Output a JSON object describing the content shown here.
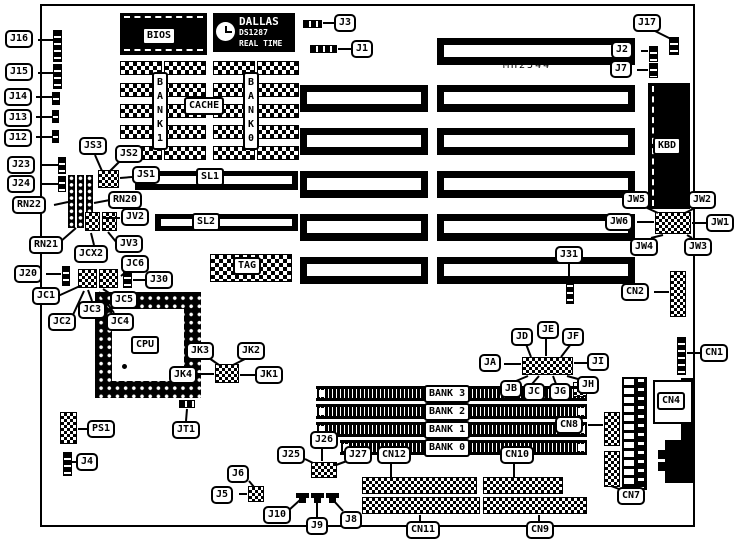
{
  "board": {
    "model_text": "MH2544"
  },
  "chips": {
    "rtc_line1": "DALLAS",
    "rtc_line2": "DS1287",
    "rtc_line3": "REAL TIME"
  },
  "plates": [
    {
      "id": "bios-label",
      "text": "BIOS",
      "x": 142,
      "y": 27
    },
    {
      "id": "cache-label",
      "text": "CACHE",
      "x": 184,
      "y": 97
    },
    {
      "id": "sram-bank-left-label",
      "text": "BANK 1",
      "x": 152,
      "y": 72,
      "vertical": true
    },
    {
      "id": "sram-bank-right-label",
      "text": "BANK 0",
      "x": 243,
      "y": 72,
      "vertical": true
    },
    {
      "id": "sl1-label",
      "text": "SL1",
      "x": 196,
      "y": 168
    },
    {
      "id": "sl2-label",
      "text": "SL2",
      "x": 192,
      "y": 213
    },
    {
      "id": "tag-label",
      "text": "TAG",
      "x": 233,
      "y": 257
    },
    {
      "id": "cpu-label",
      "text": "CPU",
      "x": 131,
      "y": 336
    },
    {
      "id": "kbd-label",
      "text": "KBD",
      "x": 653,
      "y": 137
    },
    {
      "id": "cn4-label",
      "text": "CN4",
      "x": 657,
      "y": 392
    },
    {
      "id": "simm-bank3-label",
      "text": "BANK 3",
      "x": 424,
      "y": 385
    },
    {
      "id": "simm-bank2-label",
      "text": "BANK 2",
      "x": 424,
      "y": 403
    },
    {
      "id": "simm-bank1-label",
      "text": "BANK 1",
      "x": 424,
      "y": 421
    },
    {
      "id": "simm-bank0-label",
      "text": "BANK 0",
      "x": 424,
      "y": 439
    }
  ],
  "callouts": [
    {
      "id": "j16",
      "text": "J16",
      "x": 5,
      "y": 30,
      "line": [
        38,
        40,
        53,
        40
      ]
    },
    {
      "id": "j15",
      "text": "J15",
      "x": 5,
      "y": 63,
      "line": [
        38,
        73,
        53,
        73
      ]
    },
    {
      "id": "j14",
      "text": "J14",
      "x": 4,
      "y": 88,
      "line": [
        36,
        97,
        52,
        97
      ]
    },
    {
      "id": "j13",
      "text": "J13",
      "x": 4,
      "y": 109,
      "line": [
        36,
        117,
        52,
        117
      ]
    },
    {
      "id": "j12",
      "text": "J12",
      "x": 4,
      "y": 129,
      "line": [
        36,
        137,
        52,
        137
      ]
    },
    {
      "id": "j23",
      "text": "J23",
      "x": 7,
      "y": 156,
      "line": [
        40,
        165,
        58,
        165
      ]
    },
    {
      "id": "j24",
      "text": "J24",
      "x": 7,
      "y": 175,
      "line": [
        40,
        184,
        58,
        184
      ]
    },
    {
      "id": "rn22",
      "text": "RN22",
      "x": 12,
      "y": 196,
      "line": [
        54,
        205,
        68,
        202
      ]
    },
    {
      "id": "rn21",
      "text": "RN21",
      "x": 29,
      "y": 236,
      "line": [
        60,
        242,
        76,
        228
      ]
    },
    {
      "id": "j20",
      "text": "J20",
      "x": 14,
      "y": 265,
      "line": [
        46,
        274,
        61,
        274
      ]
    },
    {
      "id": "jc1",
      "text": "JC1",
      "x": 32,
      "y": 287,
      "line": [
        58,
        296,
        80,
        286
      ]
    },
    {
      "id": "jc2",
      "text": "JC2",
      "x": 48,
      "y": 313,
      "line": [
        72,
        317,
        84,
        291
      ]
    },
    {
      "id": "js3",
      "text": "JS3",
      "x": 79,
      "y": 137,
      "line": [
        95,
        155,
        102,
        171
      ]
    },
    {
      "id": "js2",
      "text": "JS2",
      "x": 115,
      "y": 145,
      "line": [
        120,
        161,
        110,
        171
      ]
    },
    {
      "id": "js1",
      "text": "JS1",
      "x": 132,
      "y": 166,
      "line": [
        132,
        177,
        120,
        178
      ]
    },
    {
      "id": "rn20",
      "text": "RN20",
      "x": 108,
      "y": 191,
      "line": [
        110,
        200,
        94,
        203
      ]
    },
    {
      "id": "jcx2",
      "text": "JCX2",
      "x": 74,
      "y": 245,
      "line": [
        94,
        245,
        91,
        233
      ]
    },
    {
      "id": "jv3",
      "text": "JV3",
      "x": 115,
      "y": 235,
      "line": [
        117,
        243,
        108,
        232
      ]
    },
    {
      "id": "jv2",
      "text": "JV2",
      "x": 121,
      "y": 208,
      "line": [
        120,
        218,
        104,
        218
      ]
    },
    {
      "id": "jc3",
      "text": "JC3",
      "x": 78,
      "y": 301,
      "line": [
        92,
        301,
        88,
        290
      ]
    },
    {
      "id": "jc5",
      "text": "JC5",
      "x": 110,
      "y": 291,
      "line": [
        112,
        295,
        103,
        289
      ]
    },
    {
      "id": "jc4",
      "text": "JC4",
      "x": 106,
      "y": 313,
      "line": [
        114,
        313,
        99,
        292
      ]
    },
    {
      "id": "jc6",
      "text": "JC6",
      "x": 121,
      "y": 255,
      "line": [
        127,
        271,
        121,
        276
      ]
    },
    {
      "id": "j30",
      "text": "J30",
      "x": 145,
      "y": 271,
      "line": [
        145,
        280,
        133,
        280
      ]
    },
    {
      "id": "j3",
      "text": "J3",
      "x": 334,
      "y": 14,
      "line": [
        334,
        23,
        323,
        23
      ]
    },
    {
      "id": "j1",
      "text": "J1",
      "x": 351,
      "y": 40,
      "line": [
        351,
        49,
        338,
        49
      ]
    },
    {
      "id": "j17",
      "text": "J17",
      "x": 633,
      "y": 14,
      "line": [
        655,
        31,
        671,
        39
      ]
    },
    {
      "id": "j2",
      "text": "J2",
      "x": 611,
      "y": 41,
      "line": [
        641,
        51,
        648,
        51
      ]
    },
    {
      "id": "j7",
      "text": "J7",
      "x": 610,
      "y": 60,
      "line": [
        637,
        70,
        648,
        70
      ]
    },
    {
      "id": "jw5",
      "text": "JW5",
      "x": 622,
      "y": 191,
      "line": [
        645,
        207,
        658,
        213
      ]
    },
    {
      "id": "jw2",
      "text": "JW2",
      "x": 688,
      "y": 191,
      "line": [
        697,
        207,
        685,
        213
      ]
    },
    {
      "id": "jw6",
      "text": "JW6",
      "x": 605,
      "y": 213,
      "line": [
        637,
        222,
        654,
        222
      ]
    },
    {
      "id": "jw1",
      "text": "JW1",
      "x": 706,
      "y": 214,
      "line": [
        706,
        223,
        692,
        223
      ]
    },
    {
      "id": "jw4",
      "text": "JW4",
      "x": 630,
      "y": 238,
      "line": [
        651,
        238,
        663,
        235
      ]
    },
    {
      "id": "jw3",
      "text": "JW3",
      "x": 684,
      "y": 238,
      "line": [
        692,
        238,
        687,
        235
      ]
    },
    {
      "id": "j31",
      "text": "J31",
      "x": 555,
      "y": 246,
      "line": [
        569,
        263,
        569,
        278
      ]
    },
    {
      "id": "cn2",
      "text": "CN2",
      "x": 621,
      "y": 283,
      "line": [
        654,
        292,
        669,
        292
      ]
    },
    {
      "id": "cn1",
      "text": "CN1",
      "x": 700,
      "y": 344,
      "line": [
        700,
        353,
        687,
        353
      ]
    },
    {
      "id": "jd",
      "text": "JD",
      "x": 511,
      "y": 328,
      "line": [
        526,
        344,
        531,
        357
      ]
    },
    {
      "id": "je",
      "text": "JE",
      "x": 537,
      "y": 321,
      "line": [
        546,
        338,
        546,
        356
      ]
    },
    {
      "id": "jf",
      "text": "JF",
      "x": 562,
      "y": 328,
      "line": [
        571,
        344,
        561,
        357
      ]
    },
    {
      "id": "ja",
      "text": "JA",
      "x": 479,
      "y": 354,
      "line": [
        504,
        364,
        521,
        364
      ]
    },
    {
      "id": "ji",
      "text": "JI",
      "x": 587,
      "y": 353,
      "line": [
        587,
        363,
        574,
        363
      ]
    },
    {
      "id": "jb",
      "text": "JB",
      "x": 500,
      "y": 380,
      "line": [
        516,
        381,
        528,
        376
      ]
    },
    {
      "id": "jc",
      "text": "JC",
      "x": 523,
      "y": 383,
      "line": [
        532,
        384,
        539,
        376
      ]
    },
    {
      "id": "jg",
      "text": "JG",
      "x": 549,
      "y": 383,
      "line": [
        556,
        384,
        553,
        376
      ]
    },
    {
      "id": "jh",
      "text": "JH",
      "x": 577,
      "y": 376,
      "line": [
        578,
        379,
        567,
        376
      ]
    },
    {
      "id": "jk3",
      "text": "JK3",
      "x": 186,
      "y": 342,
      "line": [
        209,
        358,
        219,
        365
      ]
    },
    {
      "id": "jk2",
      "text": "JK2",
      "x": 237,
      "y": 342,
      "line": [
        247,
        358,
        233,
        365
      ]
    },
    {
      "id": "jk4",
      "text": "JK4",
      "x": 169,
      "y": 366,
      "line": [
        197,
        374,
        214,
        374
      ]
    },
    {
      "id": "jk1",
      "text": "JK1",
      "x": 255,
      "y": 366,
      "line": [
        255,
        375,
        240,
        375
      ]
    },
    {
      "id": "jt1",
      "text": "JT1",
      "x": 172,
      "y": 421,
      "line": [
        186,
        421,
        187,
        409
      ]
    },
    {
      "id": "ps1",
      "text": "PS1",
      "x": 87,
      "y": 420,
      "line": [
        87,
        429,
        78,
        429
      ]
    },
    {
      "id": "j4",
      "text": "J4",
      "x": 76,
      "y": 453,
      "line": [
        76,
        462,
        72,
        462
      ]
    },
    {
      "id": "j6",
      "text": "J6",
      "x": 227,
      "y": 465,
      "line": [
        249,
        481,
        254,
        487
      ]
    },
    {
      "id": "j5",
      "text": "J5",
      "x": 211,
      "y": 486,
      "line": [
        239,
        494,
        247,
        494
      ]
    },
    {
      "id": "j25",
      "text": "J25",
      "x": 277,
      "y": 446,
      "line": [
        305,
        459,
        313,
        463
      ]
    },
    {
      "id": "j26",
      "text": "J26",
      "x": 310,
      "y": 431,
      "line": [
        322,
        447,
        322,
        461
      ]
    },
    {
      "id": "j27",
      "text": "J27",
      "x": 344,
      "y": 446,
      "line": [
        347,
        461,
        336,
        465
      ]
    },
    {
      "id": "cn12",
      "text": "CN12",
      "x": 377,
      "y": 446,
      "line": [
        391,
        462,
        391,
        477
      ]
    },
    {
      "id": "cn10",
      "text": "CN10",
      "x": 500,
      "y": 446,
      "line": [
        514,
        462,
        514,
        477
      ]
    },
    {
      "id": "cn8",
      "text": "CN8",
      "x": 555,
      "y": 416,
      "line": [
        588,
        425,
        603,
        425
      ]
    },
    {
      "id": "cn7",
      "text": "CN7",
      "x": 617,
      "y": 487,
      "line": [
        619,
        489,
        611,
        486
      ]
    },
    {
      "id": "cn11",
      "text": "CN11",
      "x": 406,
      "y": 521,
      "line": [
        420,
        521,
        420,
        515
      ]
    },
    {
      "id": "cn9",
      "text": "CN9",
      "x": 526,
      "y": 521,
      "line": [
        539,
        521,
        539,
        515
      ]
    },
    {
      "id": "j10",
      "text": "J10",
      "x": 263,
      "y": 506,
      "line": [
        289,
        510,
        300,
        500
      ]
    },
    {
      "id": "j9",
      "text": "J9",
      "x": 306,
      "y": 517,
      "line": [
        317,
        517,
        317,
        501
      ]
    },
    {
      "id": "j8",
      "text": "J8",
      "x": 340,
      "y": 511,
      "line": [
        343,
        511,
        334,
        501
      ]
    }
  ]
}
